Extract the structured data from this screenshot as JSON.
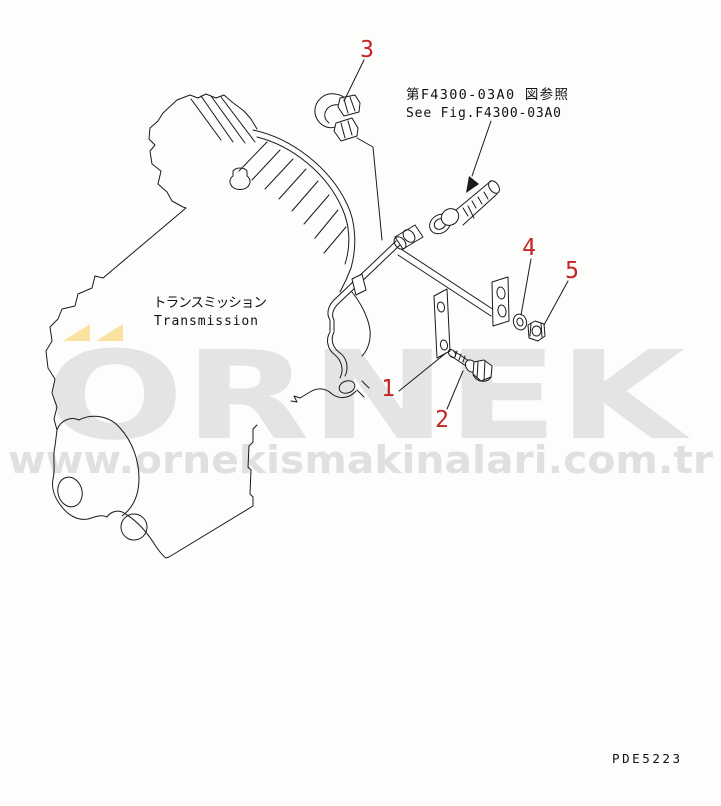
{
  "labels": {
    "component_ja": "トランスミッション",
    "component_en": "Transmission",
    "reference_ja": "第F4300-03A0 図参照",
    "reference_en": "See Fig.F4300-03A0",
    "drawing_code": "PDE5223"
  },
  "callouts": [
    "1",
    "2",
    "3",
    "4",
    "5"
  ],
  "watermark": {
    "brand": "ORNEK",
    "url": "www.ornekismakinalari.com.tr"
  },
  "colors": {
    "line": "#1a1a1a",
    "callout_red": "#c42424",
    "watermark_gray": "#e3e4e6",
    "watermark_url_gray": "#dfe0e2",
    "watermark_yellow": "#fbe2a0",
    "background": "#fdfdfb"
  }
}
